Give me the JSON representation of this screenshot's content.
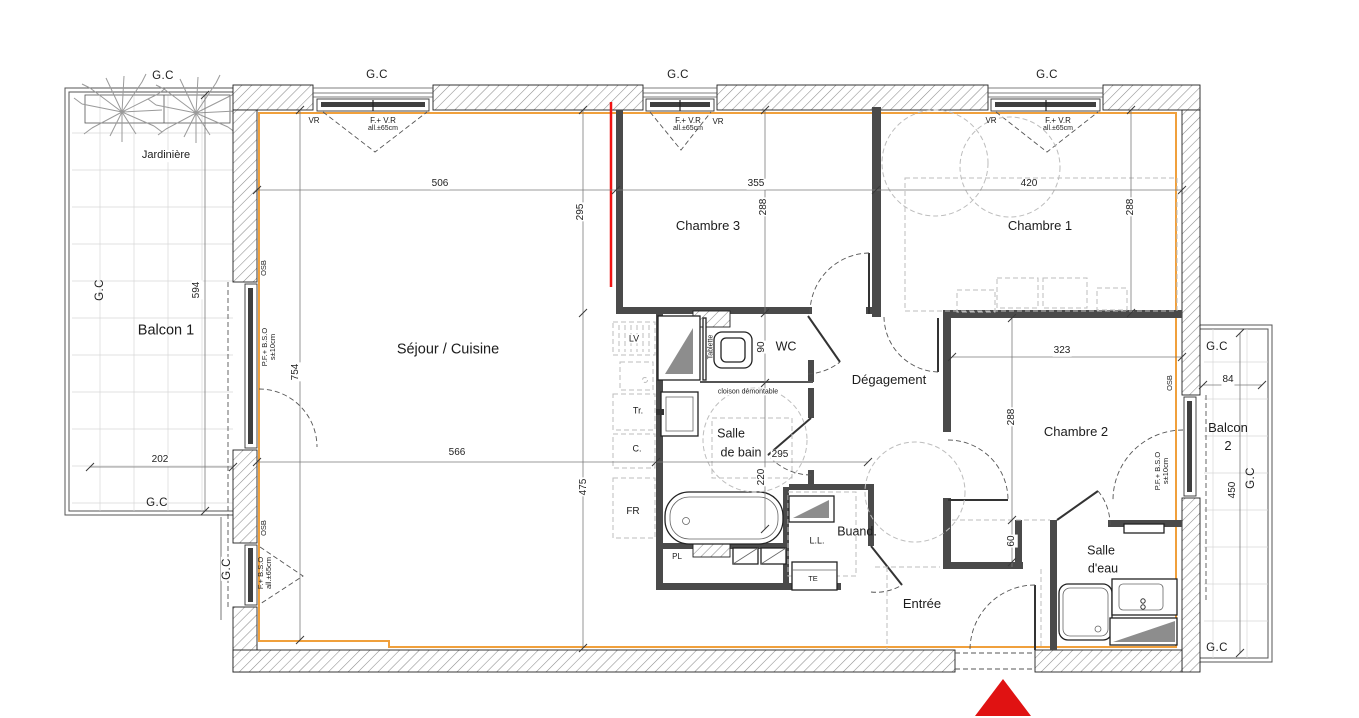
{
  "title": "Plan d'appartement 3 chambres",
  "colors": {
    "insulation": "#f0a03c",
    "marker_red": "#f01414",
    "triangle_red": "#e01212"
  },
  "rooms": {
    "jardiniere": "Jardinière",
    "balcon1": "Balcon 1",
    "balcon2_line1": "Balcon",
    "balcon2_line2": "2",
    "sejour": "Séjour / Cuisine",
    "chambre1": "Chambre 1",
    "chambre2": "Chambre 2",
    "chambre3": "Chambre 3",
    "wc": "WC",
    "degagement": "Dégagement",
    "salle_de_bain_1": "Salle",
    "salle_de_bain_2": "de bain",
    "salle_deau_1": "Salle",
    "salle_deau_2": "d'eau",
    "buanderie": "Buand.",
    "entree": "Entrée"
  },
  "fixtures": {
    "lv": "LV",
    "tr": "Tr.",
    "c": "C.",
    "fr": "FR",
    "pl": "PL",
    "ll": "L.L.",
    "te": "TE"
  },
  "annotations": {
    "gc": "G.C",
    "vr": "VR",
    "fvr": "F.+ V.R",
    "all65": "all.±65cm",
    "osb": "OSB",
    "pfbso": "P.F.+ B.S.O",
    "s10": "s±10cm",
    "fbso": "F.+ B.S.O",
    "cloison": "cloison démontable",
    "tablette": "Tablette"
  },
  "dims": {
    "balcon1_h": "594",
    "balcon1_w": "202",
    "sejour_w": "506",
    "sejour_h": "754",
    "sejour_w2": "566",
    "sejour_h2": "475",
    "strip_295": "295",
    "c3_w": "355",
    "c3_h": "288",
    "c1_w": "420",
    "c1_h": "288",
    "c2_w": "323",
    "c2_h": "288",
    "c2_closet": "60",
    "sdb_w": "295",
    "sdb_h": "220",
    "wc_h": "90",
    "balcon2_w": "84",
    "balcon2_h": "450"
  }
}
